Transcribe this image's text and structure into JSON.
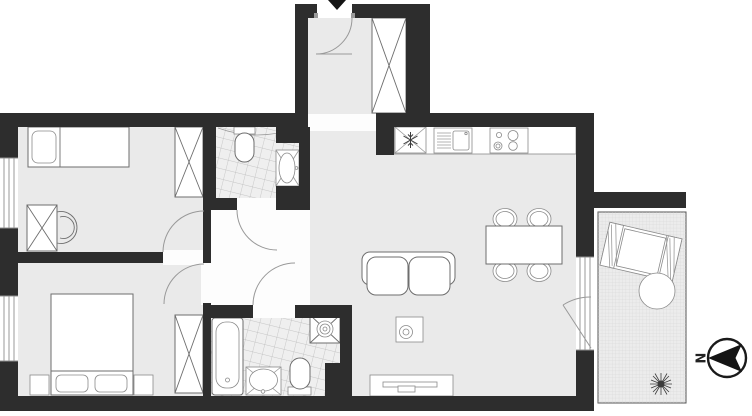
{
  "floorplan": {
    "title": "apartment-floor-plan",
    "compass": {
      "label": "N",
      "direction": "left"
    },
    "colors": {
      "wall": "#2d2d2d",
      "room_floor": "#eaeaea",
      "hallway_floor": "#fdfdfd",
      "tile_floor": "#efefef",
      "tile_line": "#b8b8b8",
      "balcony_floor": "#ececec",
      "balcony_grid": "#d2d2d2",
      "furniture_line": "#6e6e6e"
    },
    "rooms": [
      {
        "name": "entrance-vestibule",
        "fixtures": [
          "entry-door",
          "built-in-wardrobe"
        ]
      },
      {
        "name": "bedroom-1",
        "fixtures": [
          "single-bed",
          "wardrobe",
          "desk",
          "chair"
        ]
      },
      {
        "name": "wc",
        "fixtures": [
          "toilet",
          "washbasin"
        ]
      },
      {
        "name": "bedroom-2",
        "fixtures": [
          "double-bed",
          "nightstand-left",
          "nightstand-right",
          "wardrobe"
        ]
      },
      {
        "name": "bathroom",
        "fixtures": [
          "bathtub",
          "shower",
          "washbasin",
          "toilet"
        ]
      },
      {
        "name": "kitchen",
        "fixtures": [
          "fridge",
          "sink-unit",
          "stove",
          "counter"
        ]
      },
      {
        "name": "living-room",
        "fixtures": [
          "sofa",
          "coffee-table",
          "dining-table",
          "dining-chairs-x4",
          "tv-sideboard"
        ]
      },
      {
        "name": "balcony",
        "fixtures": [
          "sun-lounger",
          "round-table",
          "plant"
        ]
      }
    ],
    "icons": [
      "entry-arrow-icon",
      "snowflake-fridge-icon",
      "shower-drain-icon",
      "north-compass-icon",
      "plant-icon"
    ]
  }
}
